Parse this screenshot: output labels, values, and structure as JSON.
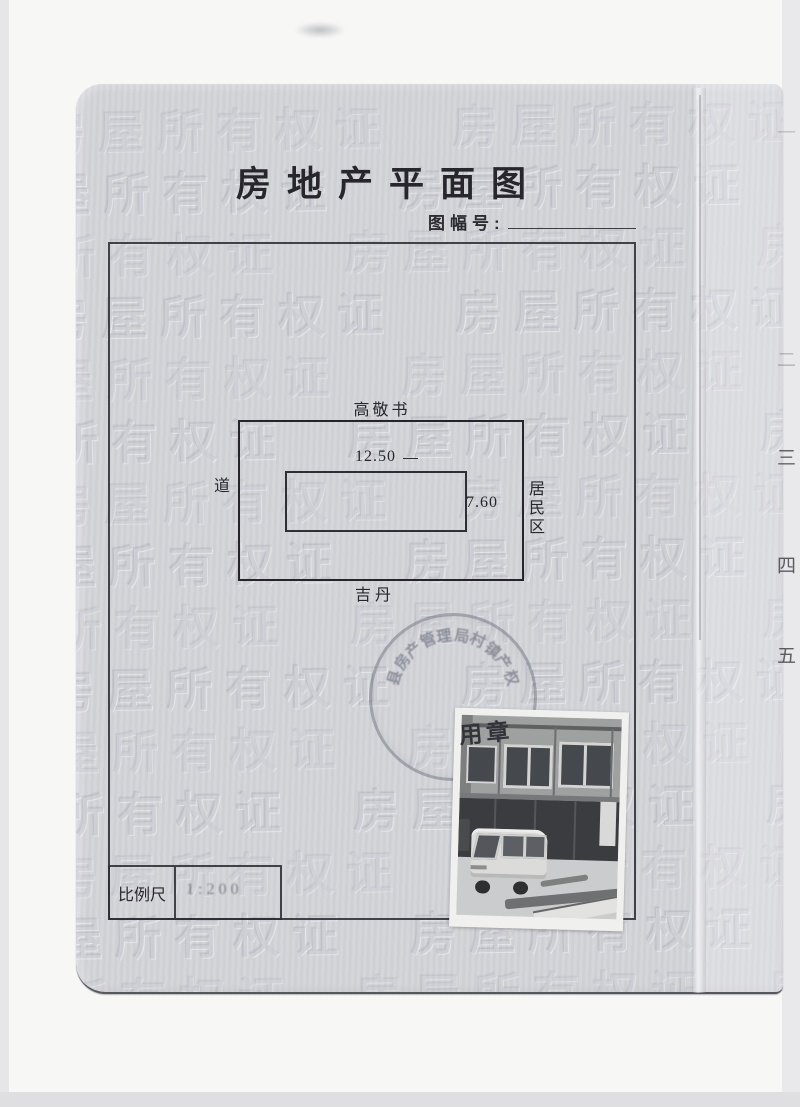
{
  "document": {
    "title": "房地产平面图",
    "sheet_number_label": "图幅号:",
    "sheet_number_value": "",
    "scale_label": "比例尺",
    "scale_value": "1:200"
  },
  "site_plan": {
    "north_neighbor": "高敬书",
    "west_label": "道",
    "east_label": "居民区",
    "south_neighbor": "吉丹",
    "building_width_m": "12.50",
    "building_depth_m": "7.60"
  },
  "stamp": {
    "arc_text": "县房产管理局村镇产权",
    "visible_bottom_text": "用章"
  },
  "watermark": {
    "text": "房屋所有权证",
    "repeat_per_row": 3,
    "rows": 15,
    "row_pitch_px": 62
  },
  "adjacent_page_numbers": {
    "items": [
      {
        "label": "一",
        "top": 118,
        "opacity": 0.2
      },
      {
        "label": "二",
        "top": 345,
        "opacity": 0.28
      },
      {
        "label": "三",
        "top": 443,
        "opacity": 0.8
      },
      {
        "label": "四",
        "top": 551,
        "opacity": 0.85
      },
      {
        "label": "五",
        "top": 641,
        "opacity": 0.85
      }
    ]
  },
  "colors": {
    "page_bg": "#d3d4d8",
    "ink": "#26262c",
    "watermark": "#989cA8",
    "stamp_ink": "#525868",
    "photo_paper": "#f0f0ee"
  }
}
